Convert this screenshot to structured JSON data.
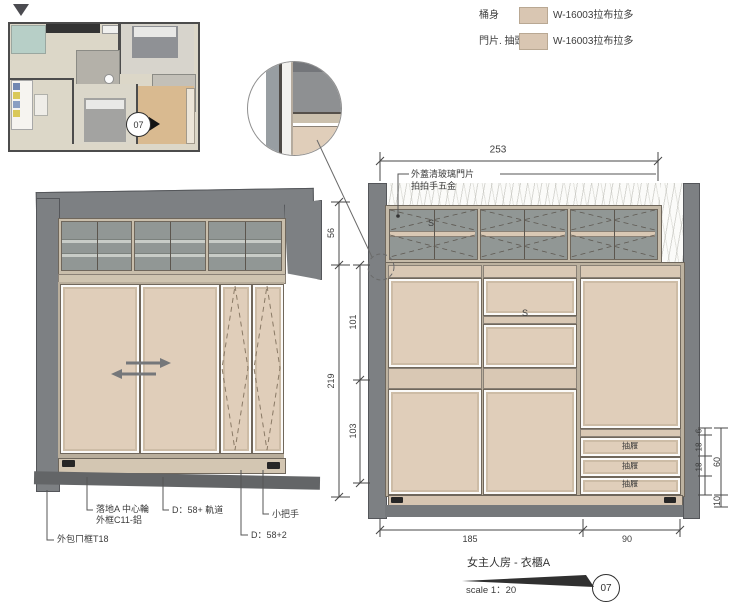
{
  "legend": {
    "rows": [
      {
        "label": "桶身",
        "value": "W-16003拉布拉多",
        "swatch": "#d9c6b2"
      },
      {
        "label": "門片. 抽頭",
        "value": "W-16003拉布拉多",
        "swatch": "#d9c6b2"
      }
    ]
  },
  "floor_plan": {
    "marker": "07"
  },
  "left_elevation": {
    "labels": {
      "frame": "外包ㄇ框T18",
      "wheel_line1": "落地A 中心輪",
      "wheel_line2": "外框C11-鋁",
      "track": "D：58+ 軌道",
      "handle": "小把手",
      "depth": "D：58+2"
    }
  },
  "right_elevation": {
    "glass_note_line1": "外蓋清玻璃門片",
    "glass_note_line2": "拍拍手五金",
    "s_glass": "S",
    "s_shelf": "S",
    "drawers": [
      "抽屜",
      "抽屜",
      "抽屜"
    ],
    "dims": {
      "top": "253",
      "left_outer": [
        "56",
        "219"
      ],
      "left_inner": [
        "101",
        "103"
      ],
      "right_inner": [
        "6",
        "18",
        "18"
      ],
      "right_outer": [
        "60",
        "10"
      ],
      "bottom": [
        "185",
        "90"
      ]
    }
  },
  "title_block": {
    "title": "女主人房 - 衣櫃A",
    "scale": "scale 1：20",
    "number": "07"
  },
  "colors": {
    "door_panel": "#e0ceba",
    "frame_tan": "#c6bba9",
    "glass_gray": "#919795",
    "wall_gray": "#7d8083"
  }
}
